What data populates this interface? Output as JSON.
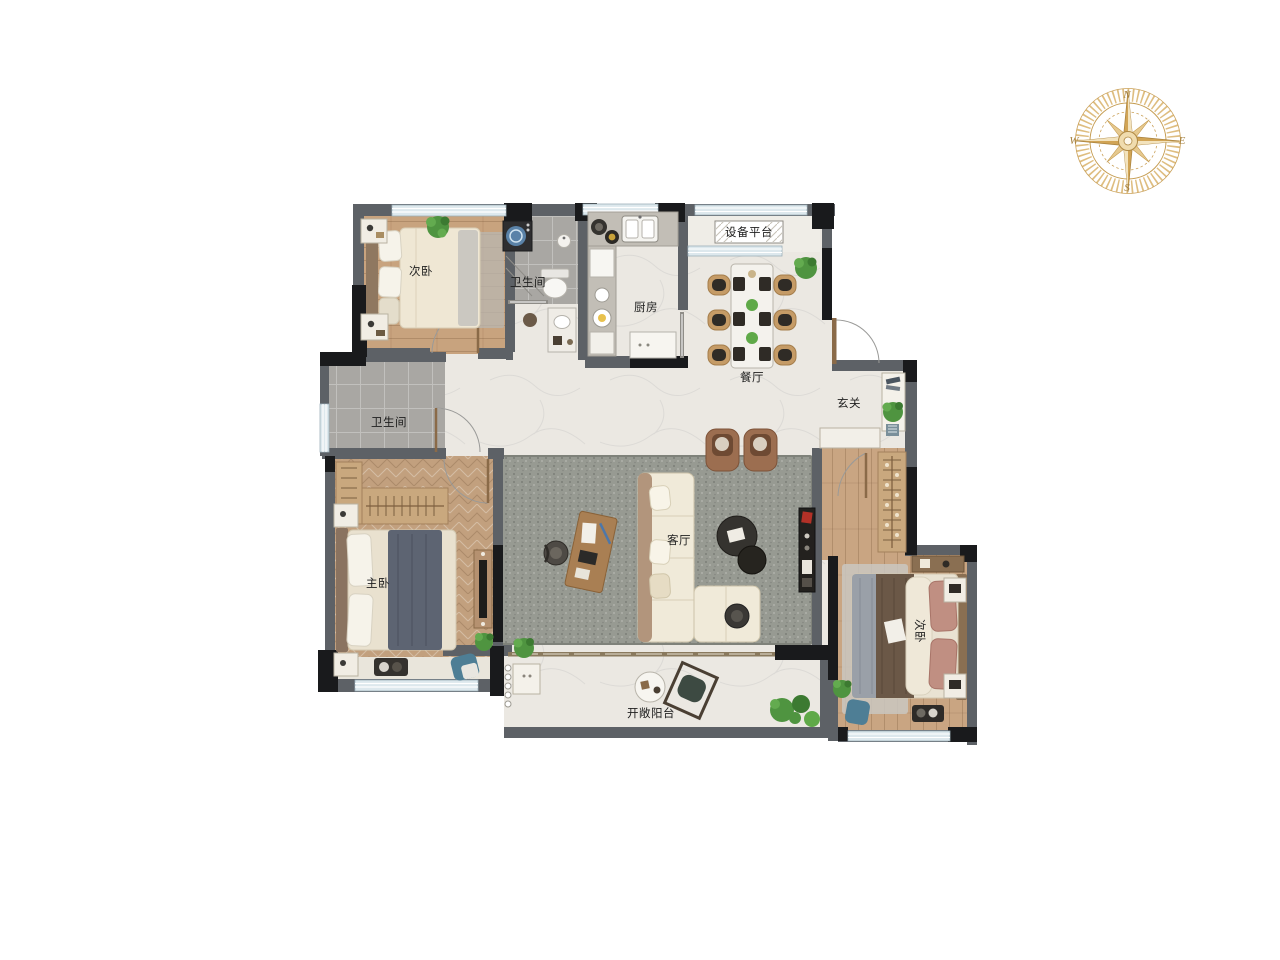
{
  "title": "residential-floor-plan",
  "compass": {
    "north": "N",
    "east": "E",
    "south": "S",
    "west": "W"
  },
  "rooms": {
    "bedroom_top_left": "次卧",
    "bathroom_top": "卫生间",
    "kitchen": "厨房",
    "equipment_platform": "设备平台",
    "dining_room": "餐厅",
    "foyer": "玄关",
    "bathroom_left": "卫生间",
    "master_bedroom": "主卧",
    "living_room": "客厅",
    "bedroom_right": "次卧",
    "balcony": "开敞阳台"
  },
  "colors": {
    "wall_gray": "#5d6166",
    "wall_column_black": "#191a1c",
    "floor_marble": "#ebe8e2",
    "floor_wood": "#c8a37e",
    "floor_tile_gray": "#a9a7a3",
    "living_rug": "#979a92",
    "sofa_cream": "#f0ead9",
    "armchair_brown": "#9c6e50",
    "accent_plant_green": "#4f9440",
    "accent_chair_blue": "#4e7e95",
    "window_glass": "#dde8ed",
    "compass_gold": "#cda356"
  }
}
